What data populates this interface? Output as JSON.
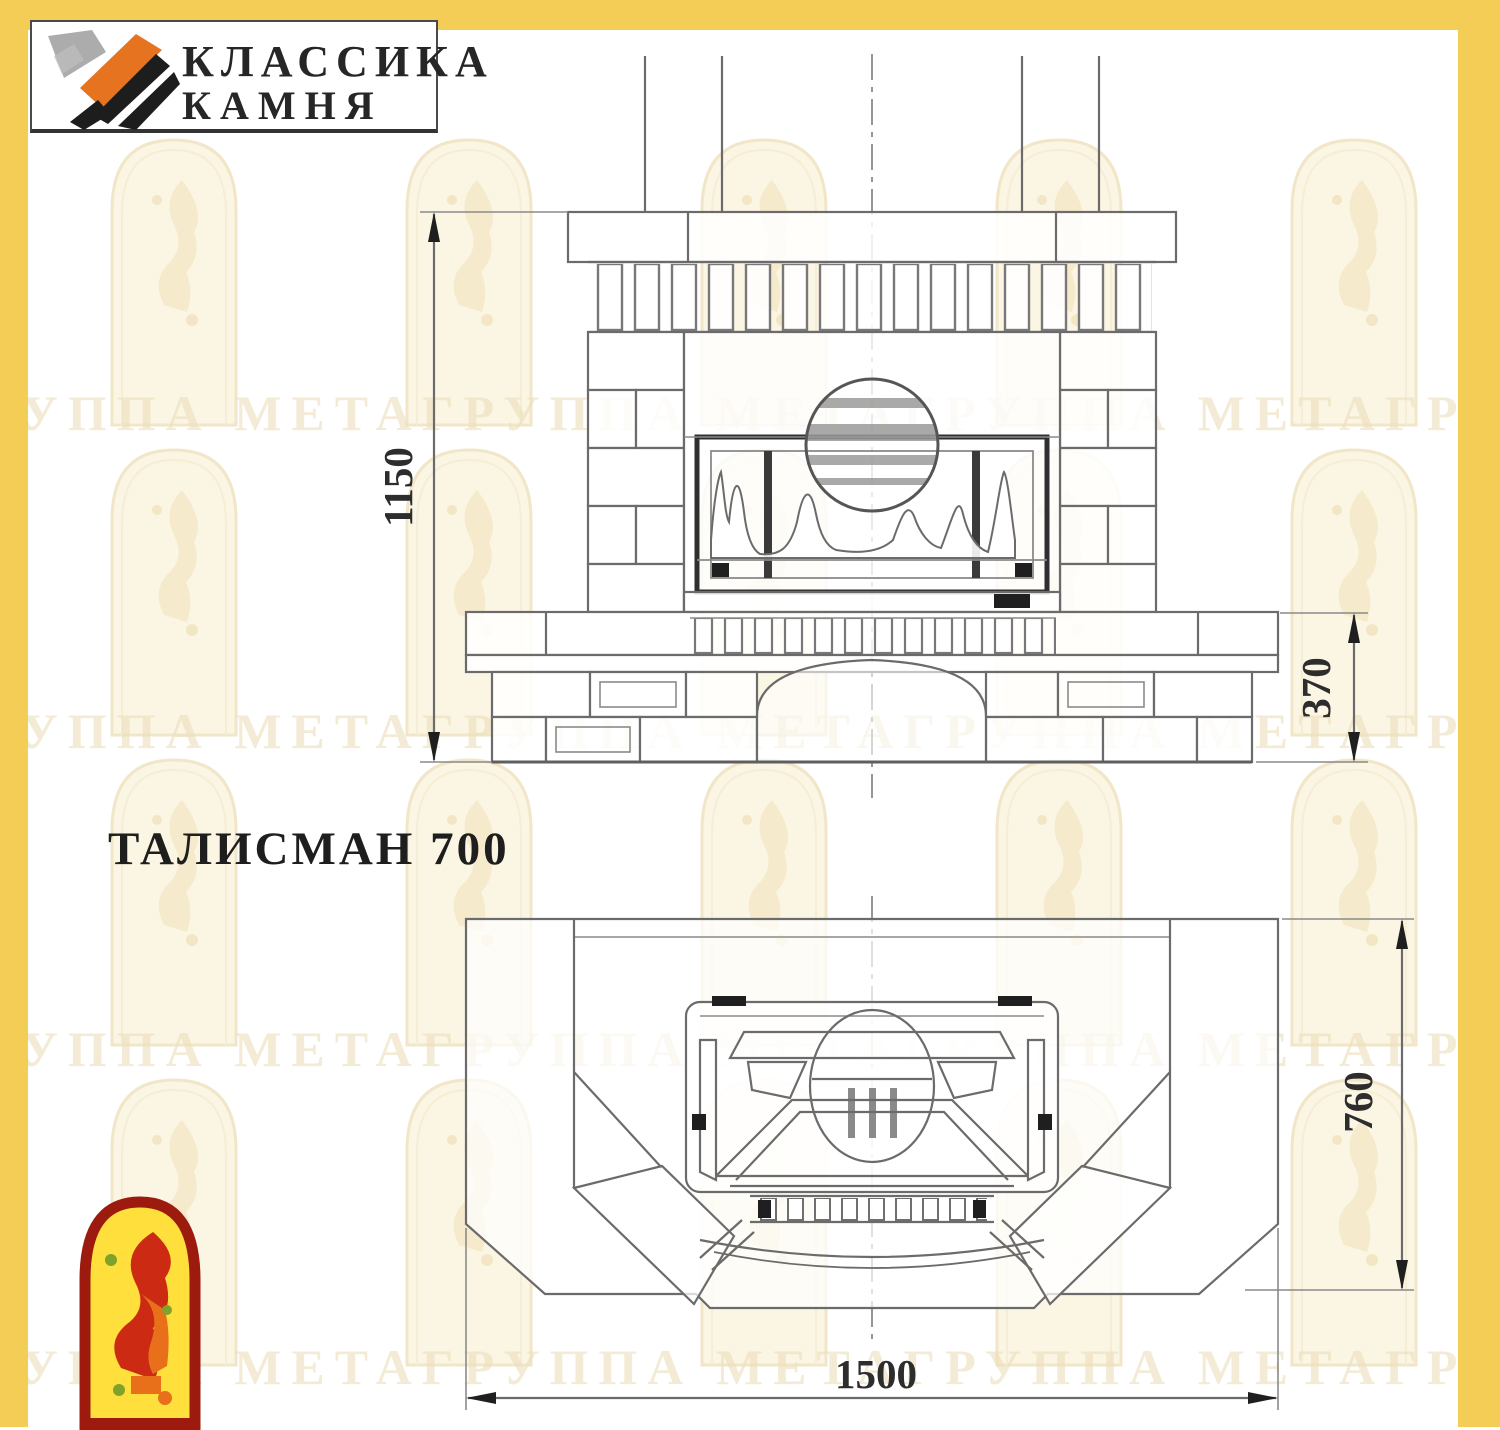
{
  "brand": {
    "line1": "КЛАССИКА",
    "line2": "КАМНЯ",
    "logo_icon": "stone-brush-mark"
  },
  "title": {
    "model": "ТАЛИСМАН 700"
  },
  "views": {
    "front": {
      "name": "front elevation",
      "dim_total_height": "1150",
      "dim_plinth_height": "370"
    },
    "plan": {
      "name": "top plan",
      "dim_depth": "760",
      "dim_width": "1500"
    }
  },
  "watermark": {
    "row_text": "ГРУППА МЕТАГРУППА МЕТАГРУППА МЕТАГРУППА МЕТА",
    "arch_icon": "arch-figure-watermark"
  },
  "footer": {
    "emblem_icon": "meta-arch-emblem"
  },
  "colors": {
    "frame_yellow": "#F4CD56",
    "line_gray": "#6b6b6b",
    "dark_line": "#2f2f2f",
    "emblem_red": "#9D1B0E",
    "emblem_yellow": "#FFDF3C",
    "logo_orange": "#E5731F"
  }
}
